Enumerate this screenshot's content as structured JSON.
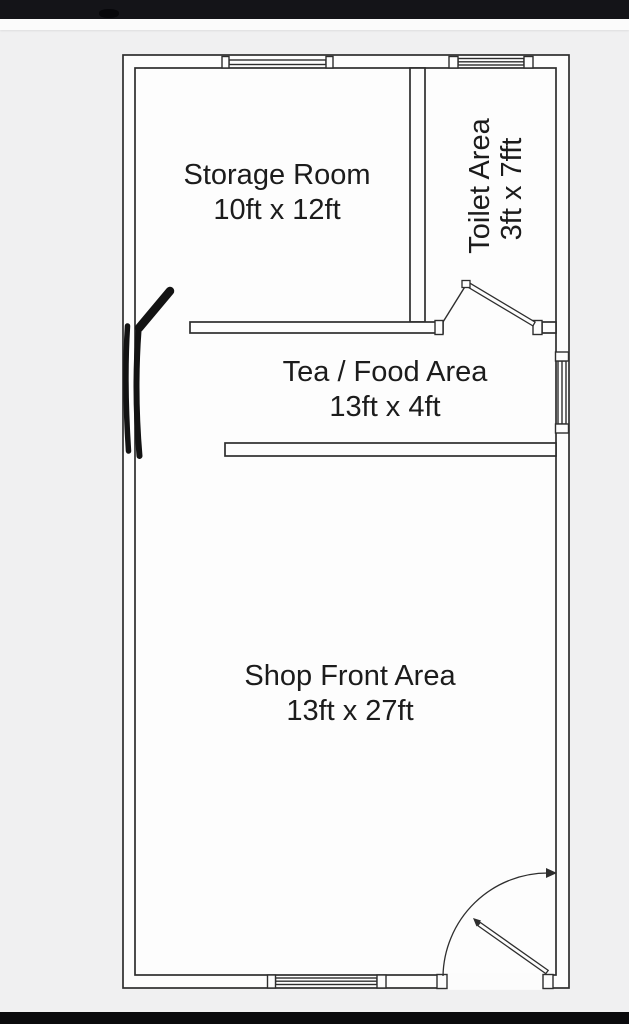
{
  "title": "Shop floor plan sketch",
  "colors": {
    "line": "#2e2e2e",
    "paper": "#fdfdfd",
    "background": "#f0f0f1",
    "top_bar": "#141418",
    "bottom_bar": "#0a0a0c",
    "marker_annotation": "#131313"
  },
  "rooms": {
    "storage": {
      "name": "Storage Room",
      "dims": "10ft x 12ft"
    },
    "toilet": {
      "name": "Toilet Area",
      "dims": "3ft x 7fft"
    },
    "tea": {
      "name": "Tea / Food Area",
      "dims": "13ft x 4ft"
    },
    "shop": {
      "name": "Shop Front Area",
      "dims": "13ft x 27ft"
    }
  }
}
